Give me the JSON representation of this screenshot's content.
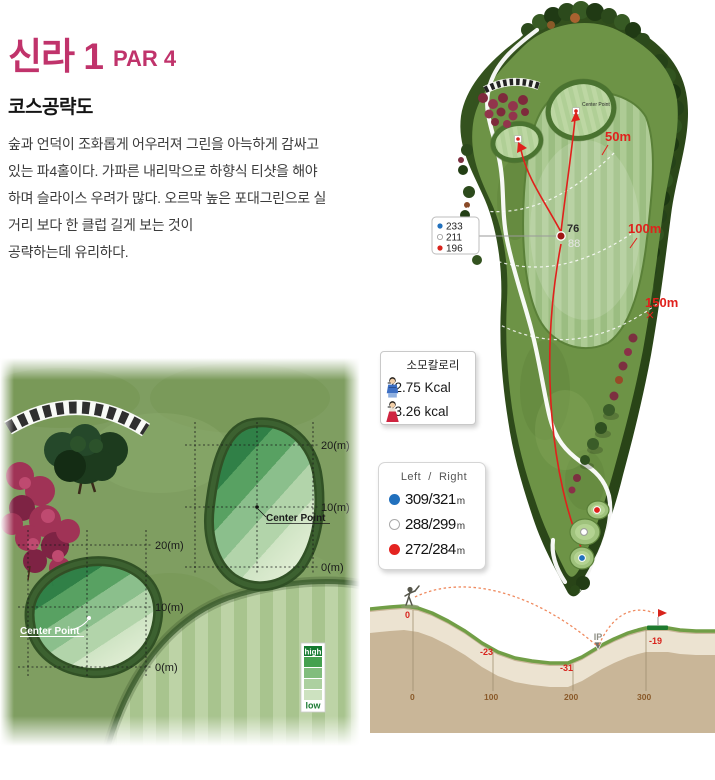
{
  "header": {
    "title": "신라 1",
    "par": "PAR 4"
  },
  "course_guide": {
    "heading": "코스공략도",
    "lines": [
      "숲과 언덕이 조화롭게 어우러져 그린을 아늑하게 감싸고",
      "있는 파4홀이다. 가파른 내리막으로 하향식 티샷을 해야",
      "하며 슬라이스 우려가 많다. 오르막 높은 포대그린으로 실",
      "거리 보다 한 클럽 길게 보는 것이",
      "공략하는데 유리하다."
    ]
  },
  "hole_map": {
    "arc_labels": {
      "m50": "50m",
      "m100": "100m",
      "m150": "150m"
    },
    "tee_distances": {
      "blue": "233",
      "white": "211",
      "red": "196"
    },
    "ip_labels": {
      "front": "76",
      "back": "88"
    },
    "center_point": "Center Point"
  },
  "calorie_box": {
    "title": "소모칼로리",
    "male_value": "72.75 Kcal",
    "female_value": "73.26 kcal"
  },
  "distance_box": {
    "header": {
      "left": "Left",
      "separator": "/",
      "right": "Right"
    },
    "rows": [
      {
        "tee": "blue",
        "value": "309/321",
        "unit": "m"
      },
      {
        "tee": "white",
        "value": "288/299",
        "unit": "m"
      },
      {
        "tee": "red",
        "value": "272/284",
        "unit": "m"
      }
    ]
  },
  "green_detail": {
    "center_point": "Center Point",
    "right_green_ticks": [
      "20(m)",
      "10(m)",
      "0(m)"
    ],
    "left_green_ticks": [
      "20(m)",
      "10(m)",
      "0(m)"
    ],
    "legend": {
      "high": "high",
      "low": "low"
    }
  },
  "elevation": {
    "ip": "IP",
    "drop_labels": [
      "0",
      "-23",
      "-31",
      "-19"
    ],
    "distance_labels": [
      "0",
      "100",
      "200",
      "300"
    ]
  },
  "colors": {
    "accent": "#c0336b",
    "marker_red": "#e0211c",
    "tee_blue": "#2170bd",
    "tee_red": "#e42320",
    "green_dark": "#157a31",
    "earth_tan": "#c9b698"
  }
}
